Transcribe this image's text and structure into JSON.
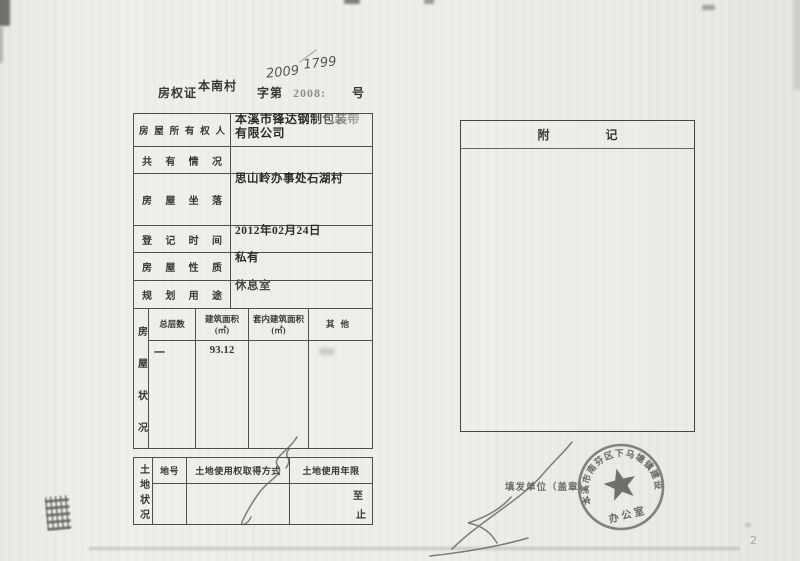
{
  "document": {
    "page_number": "2",
    "header": {
      "cert_type": "房权证",
      "cert_region": "本南村",
      "zi_di_label": "字第",
      "printed_number": "2008:",
      "handwritten_year": "2009",
      "handwritten_serial": "1799",
      "hao_label": "号"
    },
    "owner_table": {
      "rows": [
        {
          "label": "房屋所有权人",
          "value": "本溪市锋达钢制包装带有限公司"
        },
        {
          "label": "共有情况",
          "value": ""
        },
        {
          "label": "房屋坐落",
          "value": "思山岭办事处石湖村"
        },
        {
          "label": "登记时间",
          "value": "2012年02月24日"
        },
        {
          "label": "房屋性质",
          "value": "私有"
        },
        {
          "label": "规划用途",
          "value": "休息室"
        }
      ]
    },
    "house_status": {
      "side_label": "房屋状况",
      "columns": [
        {
          "name": "总层数",
          "unit": ""
        },
        {
          "name": "建筑面积",
          "unit": "(㎡)"
        },
        {
          "name": "套内建筑面积",
          "unit": "(㎡)"
        },
        {
          "name": "其他",
          "unit": ""
        }
      ],
      "row": {
        "floors": "一",
        "building_area": "93.12",
        "inner_area": "",
        "other": ""
      }
    },
    "land_status": {
      "side_label": "土地状况",
      "columns": [
        "地号",
        "土地使用权取得方式",
        "土地使用年限"
      ],
      "term_from": "至",
      "term_to": "止"
    },
    "remarks": {
      "title": "附记"
    },
    "issuing": {
      "unit_label": "填发单位（盖章）",
      "seal_arc_text": "本溪市南芬区下马塘镇建设",
      "seal_office_text": "办公室"
    }
  },
  "colors": {
    "paper": "#edece8",
    "ink": "#33312c",
    "table_line": "#514f4a",
    "faded_ink": "#8f8d87",
    "seal_ink": "#5c5a55"
  }
}
